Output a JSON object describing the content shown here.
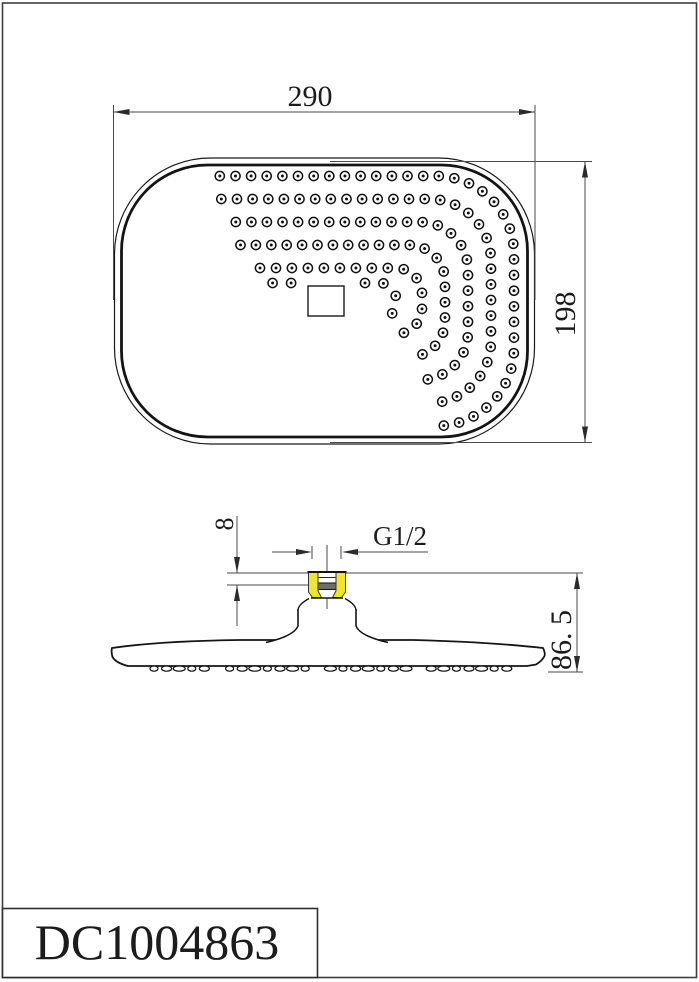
{
  "title_block": {
    "part_number": "DC1004863"
  },
  "dimensions": {
    "width": {
      "label": "290"
    },
    "height": {
      "label": "198"
    },
    "thread_spec": {
      "label": "G1/2"
    },
    "thread_height": {
      "label": "8"
    },
    "total_height": {
      "label": "86. 5"
    }
  },
  "colors": {
    "object_line": "#1a1a1a",
    "dim_line": "#4a4a4a",
    "accent_yellow": "#f0e42c",
    "background": "#ffffff",
    "border": "#3f3f3f"
  }
}
